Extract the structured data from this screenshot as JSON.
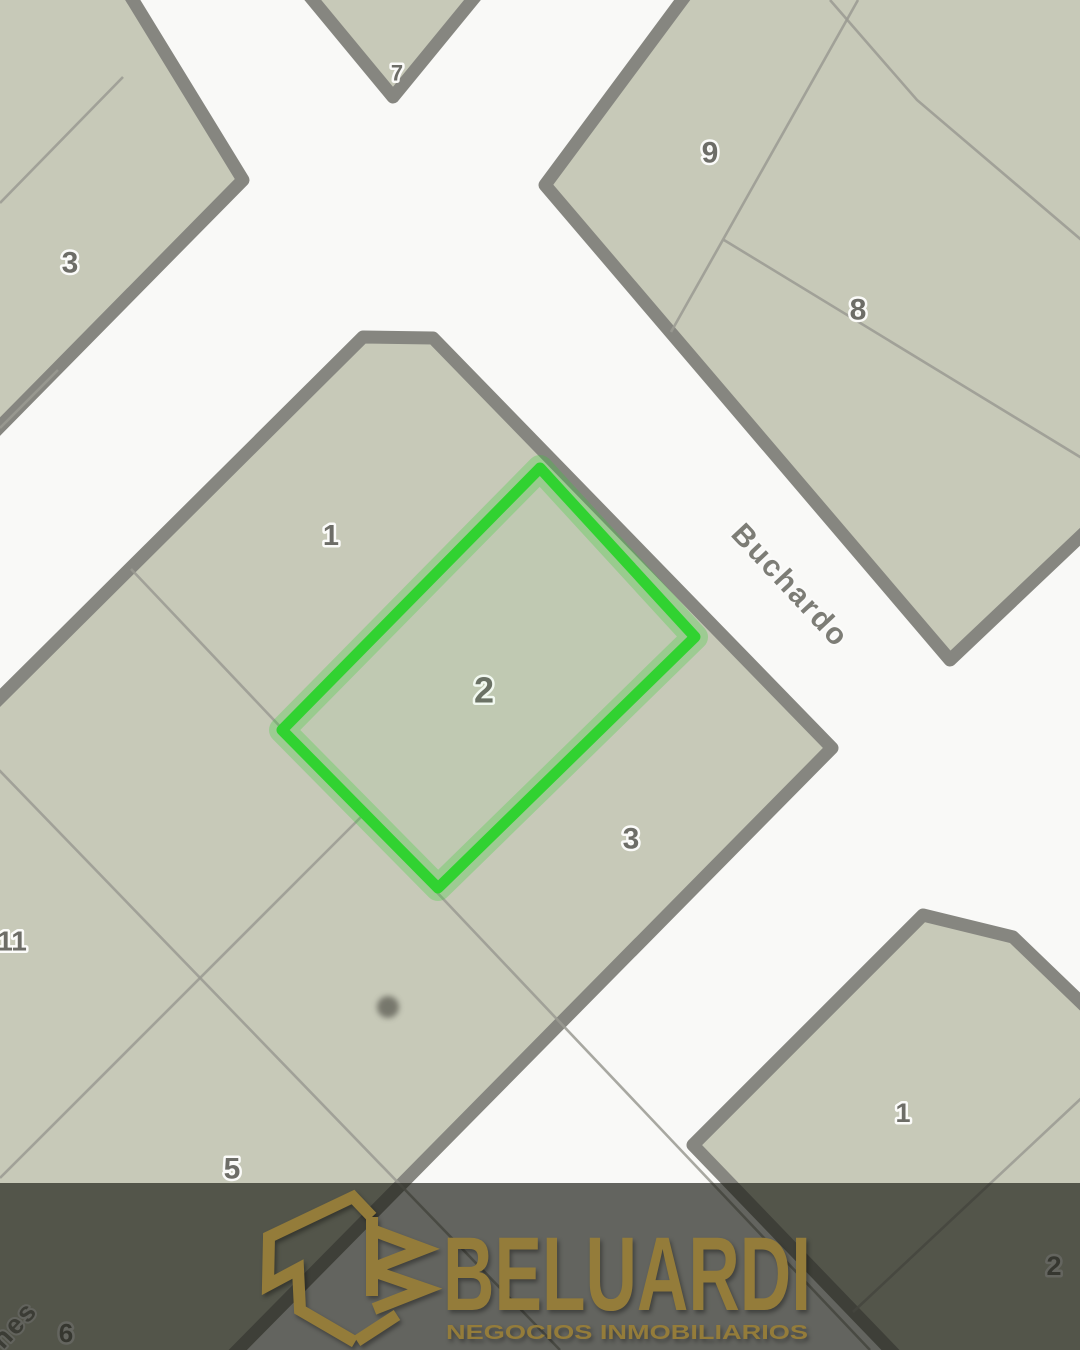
{
  "map": {
    "streets": {
      "buchardo": "Buchardo",
      "jazmines": "Jazmines"
    },
    "highlighted_lot": {
      "label": "2",
      "outline_color": "#31d231"
    },
    "labels": {
      "tl_3": "3",
      "tip_7": "7",
      "tr_9": "9",
      "tr_8": "8",
      "c_1": "1",
      "c_2": "2",
      "c_3": "3",
      "c_11": "11",
      "c_5": "5",
      "c_6": "6",
      "br_1": "1",
      "br_2": "2"
    },
    "colors": {
      "street": "#f9f9f7",
      "block_fill": "#c7c9b8",
      "road_border": "#868680",
      "parcel_line": "#9a9a92",
      "label_text": "#6d6d67",
      "street_label_text": "#7d7d76",
      "tree_marker": "#63635a"
    }
  },
  "brand": {
    "monogram": "JB",
    "name": "BELUARDI",
    "tagline": "NEGOCIOS INMOBILIARIOS",
    "gold": "#947c3a"
  }
}
